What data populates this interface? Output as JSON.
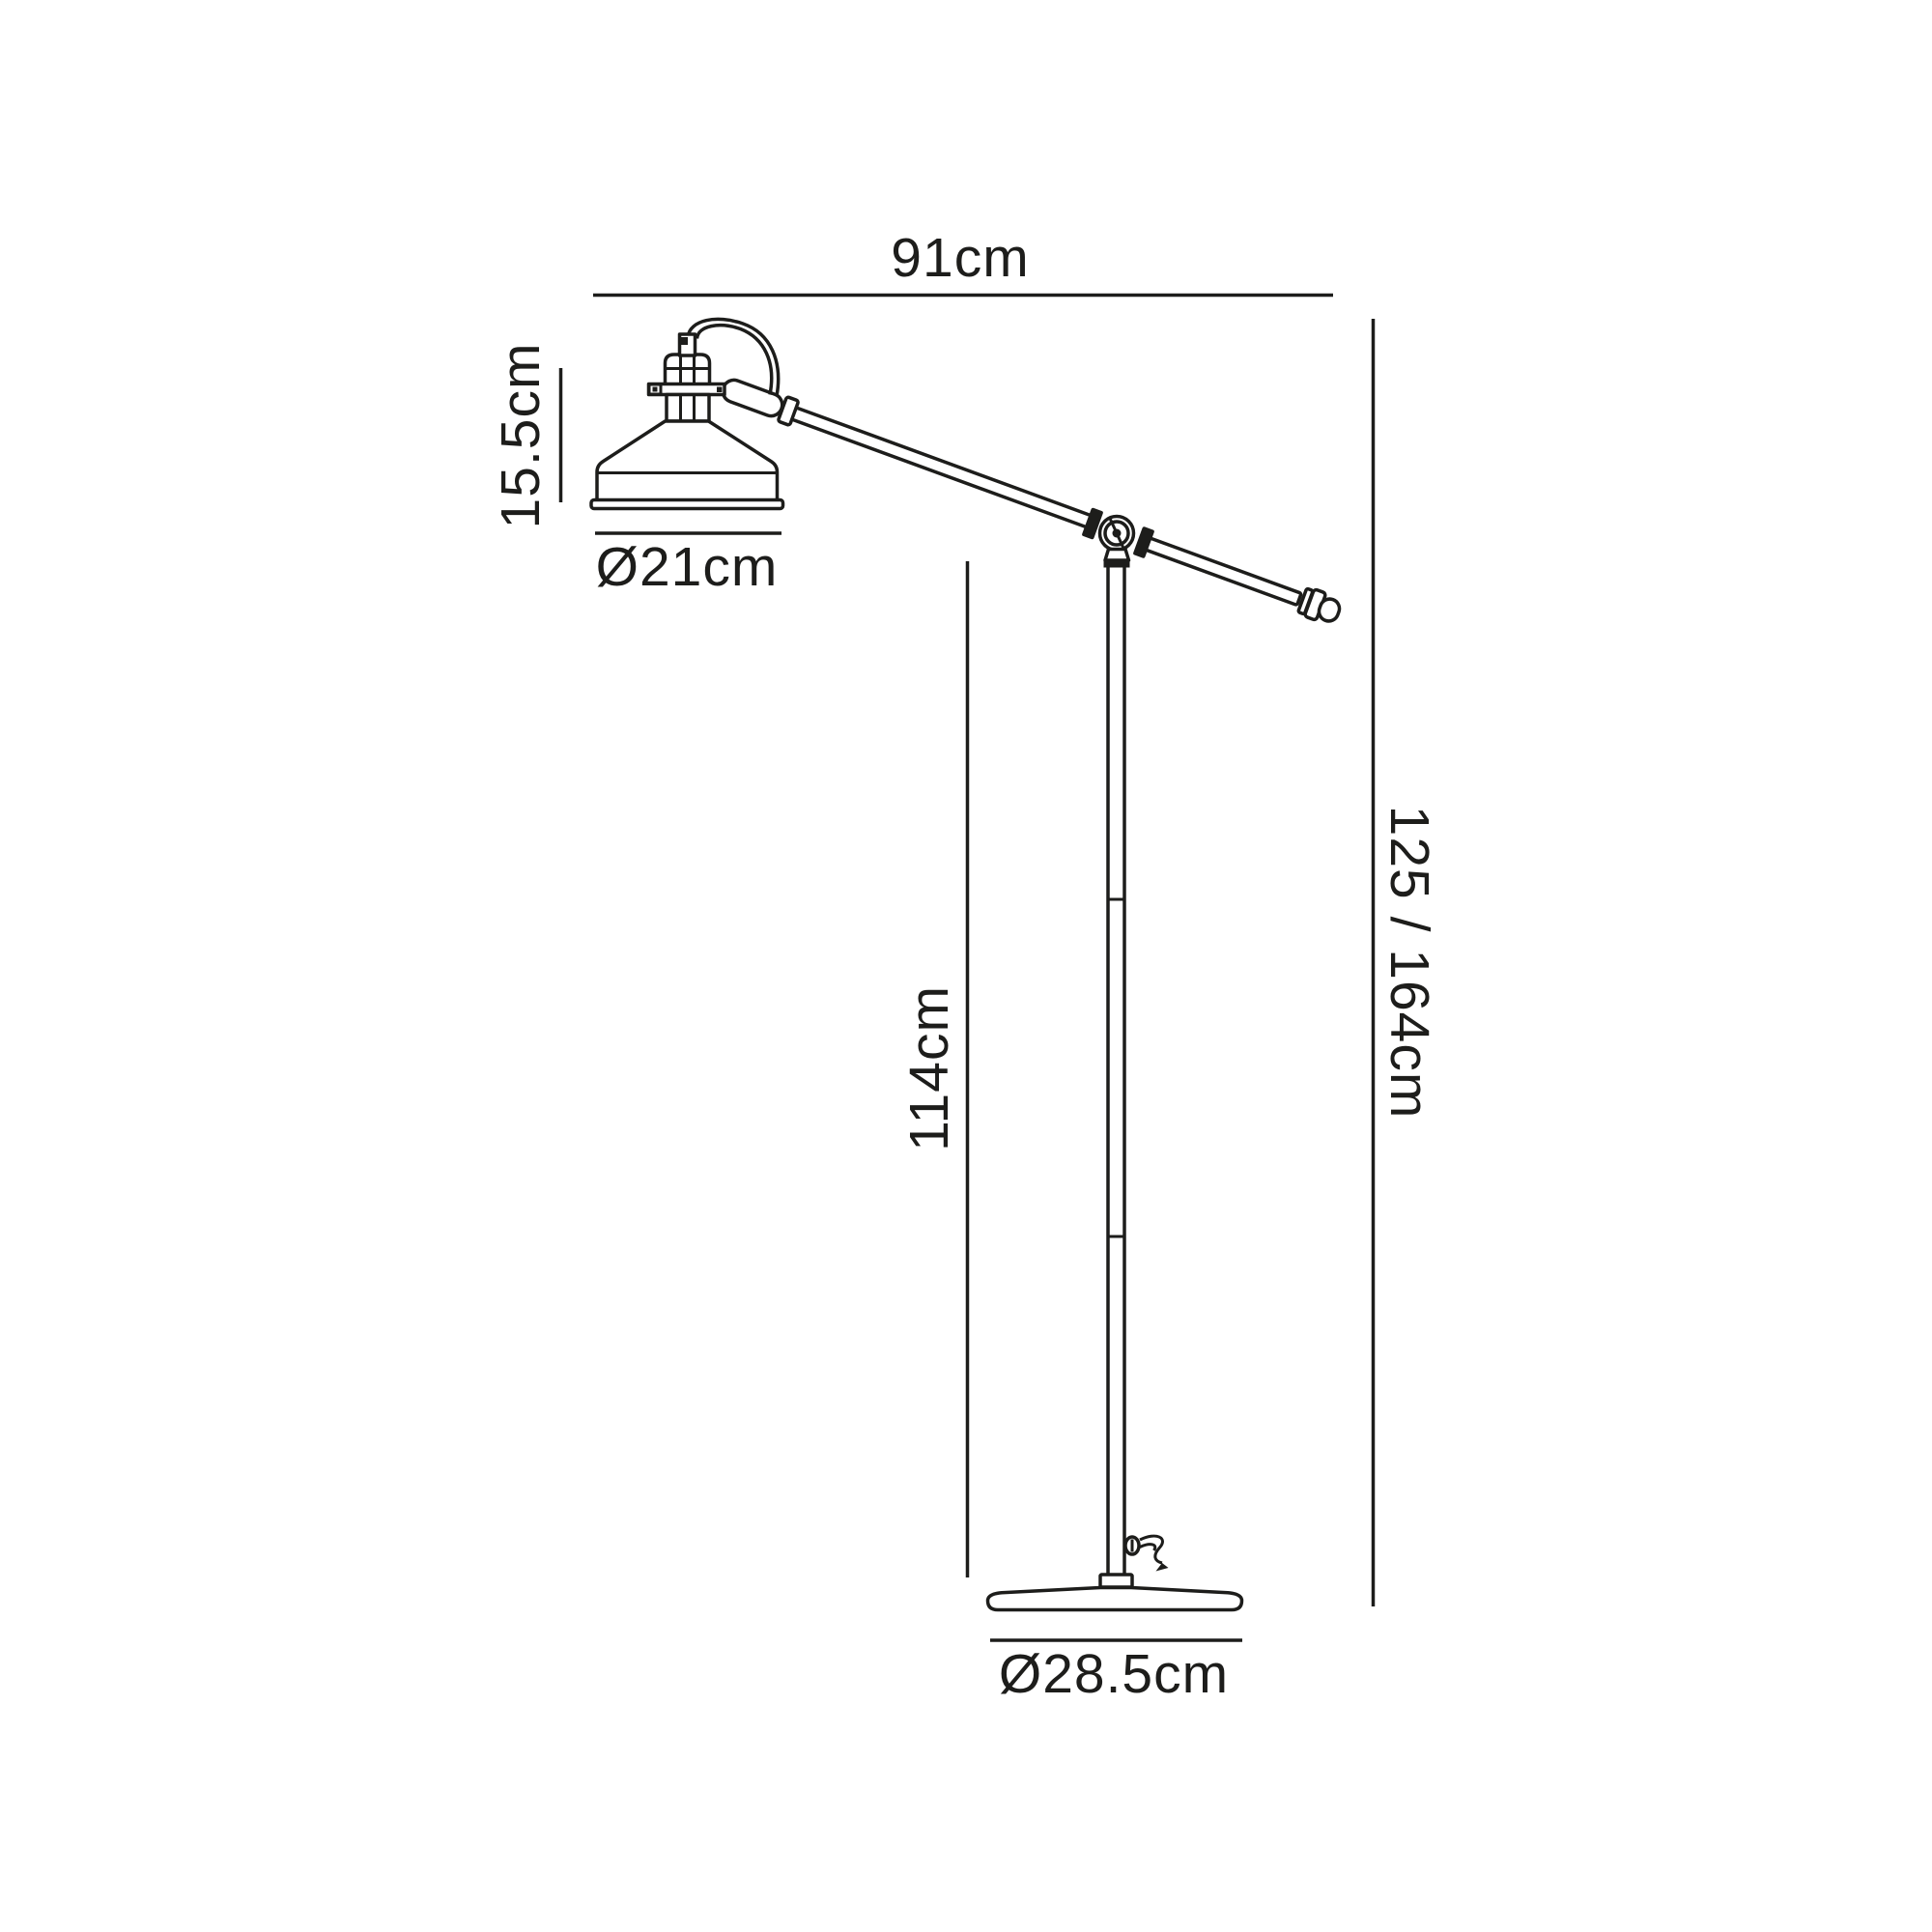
{
  "diagram": {
    "background": "#ffffff",
    "line_color": "#1d1d1b",
    "labels": {
      "arm_length": "91cm",
      "shade_height": "15.5cm",
      "shade_diameter": "Ø21cm",
      "pole_height": "114cm",
      "overall_height": "125 / 164cm",
      "base_diameter": "Ø28.5cm"
    }
  }
}
